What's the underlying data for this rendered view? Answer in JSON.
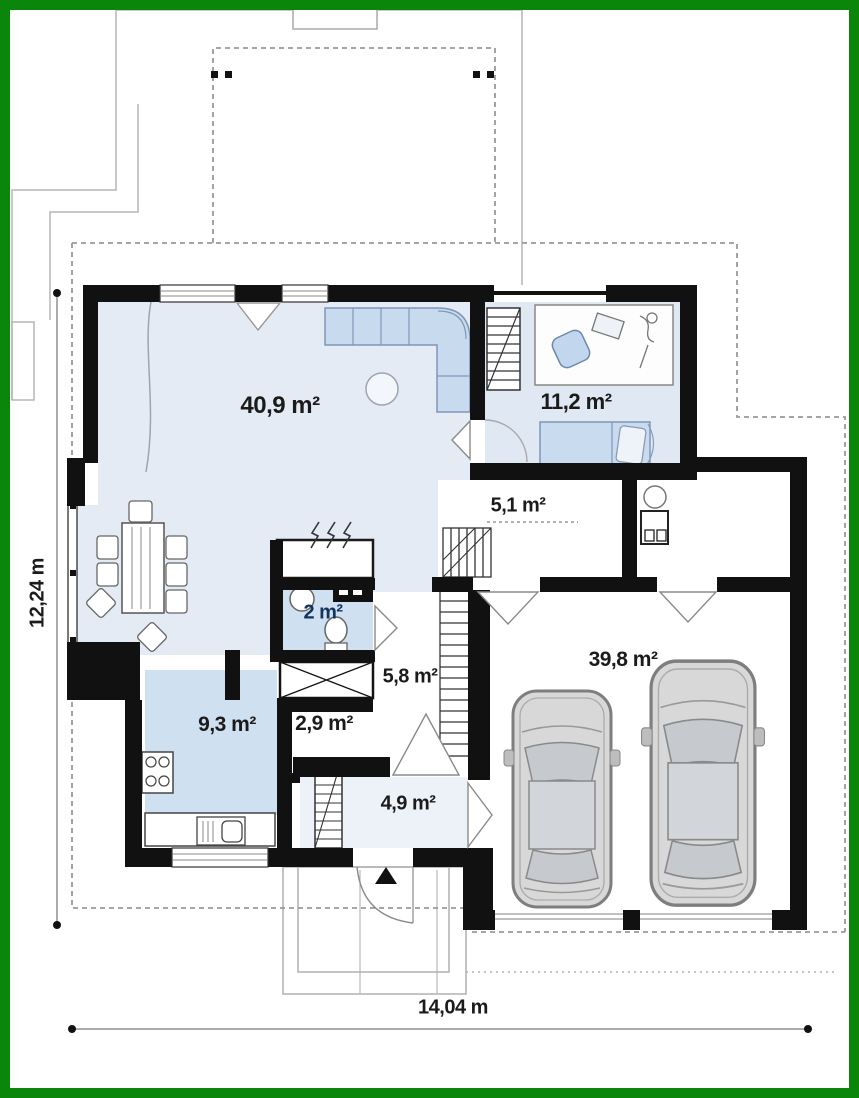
{
  "plan": {
    "type": "floor-plan",
    "rooms": [
      {
        "id": "living-room",
        "area_label": "40,9 m²"
      },
      {
        "id": "bedroom",
        "area_label": "11,2 m²"
      },
      {
        "id": "hall",
        "area_label": "5,1 m²"
      },
      {
        "id": "wc",
        "area_label": "2 m²"
      },
      {
        "id": "hallway",
        "area_label": "5,8 m²"
      },
      {
        "id": "kitchen",
        "area_label": "9,3 m²"
      },
      {
        "id": "corridor",
        "area_label": "2,9 m²"
      },
      {
        "id": "entry",
        "area_label": "4,9 m²"
      },
      {
        "id": "garage",
        "area_label": "39,8 m²"
      }
    ],
    "dimensions": {
      "total_width": "14,04 m",
      "total_depth": "12,24 m"
    },
    "colors": {
      "frame_green": "#0a870a",
      "wall_black": "#111111",
      "floor_light_blue": "#e4ebf5",
      "floor_blue": "#cfe0f1",
      "furniture_blue": "#c8daee",
      "line_gray": "#999999"
    }
  }
}
